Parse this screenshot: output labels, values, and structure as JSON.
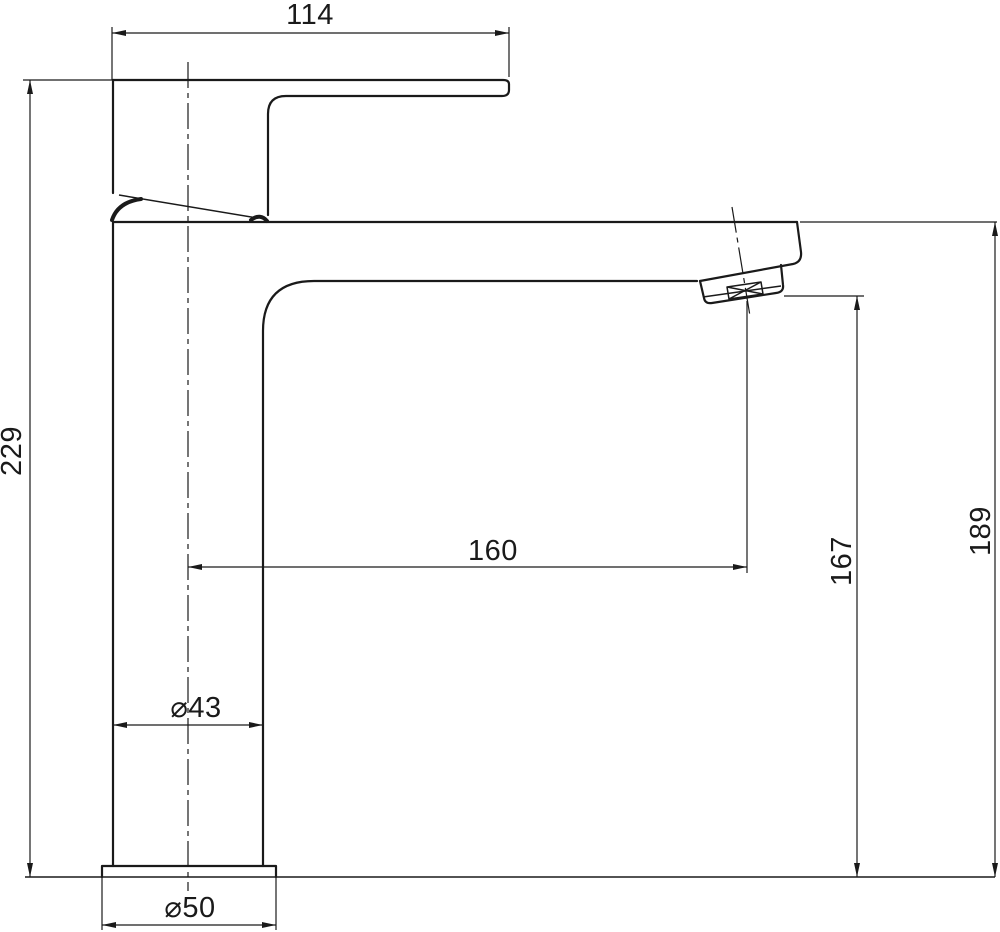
{
  "colors": {
    "line": "#1a1a1a",
    "background": "#ffffff"
  },
  "dimensions": {
    "handle_length": "114",
    "total_height": "229",
    "spout_reach": "160",
    "outlet_height": "167",
    "deck_to_spout_top": "189",
    "body_diameter": "⌀43",
    "base_diameter": "⌀50"
  }
}
